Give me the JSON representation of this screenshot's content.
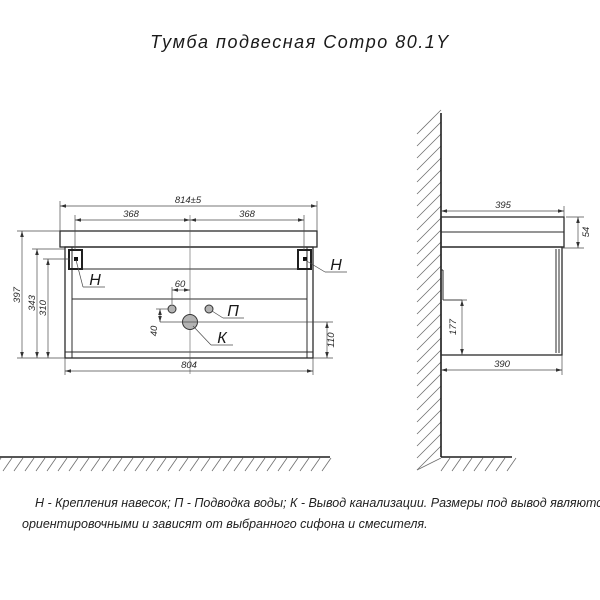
{
  "title": "Тумба подвесная Compo 80.1Y",
  "front_view": {
    "dims": {
      "overall_width": "814±5",
      "bracket_left_span": "368",
      "bracket_right_span": "368",
      "overall_height": "397",
      "body_height": "343",
      "bracket_height": "310",
      "water_offset": "60",
      "water_to_drain": "40",
      "drain_height": "110",
      "body_width": "804"
    },
    "labels": {
      "bracket_left": "Н",
      "bracket_right": "Н",
      "water_supply": "П",
      "drain": "К"
    }
  },
  "side_view": {
    "dims": {
      "top_depth": "395",
      "top_height": "54",
      "notch_height": "177",
      "body_depth": "390"
    }
  },
  "note": {
    "line1": "Н - Крепления навесок; П - Подводка воды; К - Вывод канализации. Размеры под вывод являются",
    "line2": "ориентировочными и зависят от выбранного сифона и смесителя."
  },
  "colors": {
    "line": "#2b2b2b",
    "hatch": "#6f6f6f",
    "background": "#ffffff",
    "port_fill": "#b3b3b3"
  }
}
